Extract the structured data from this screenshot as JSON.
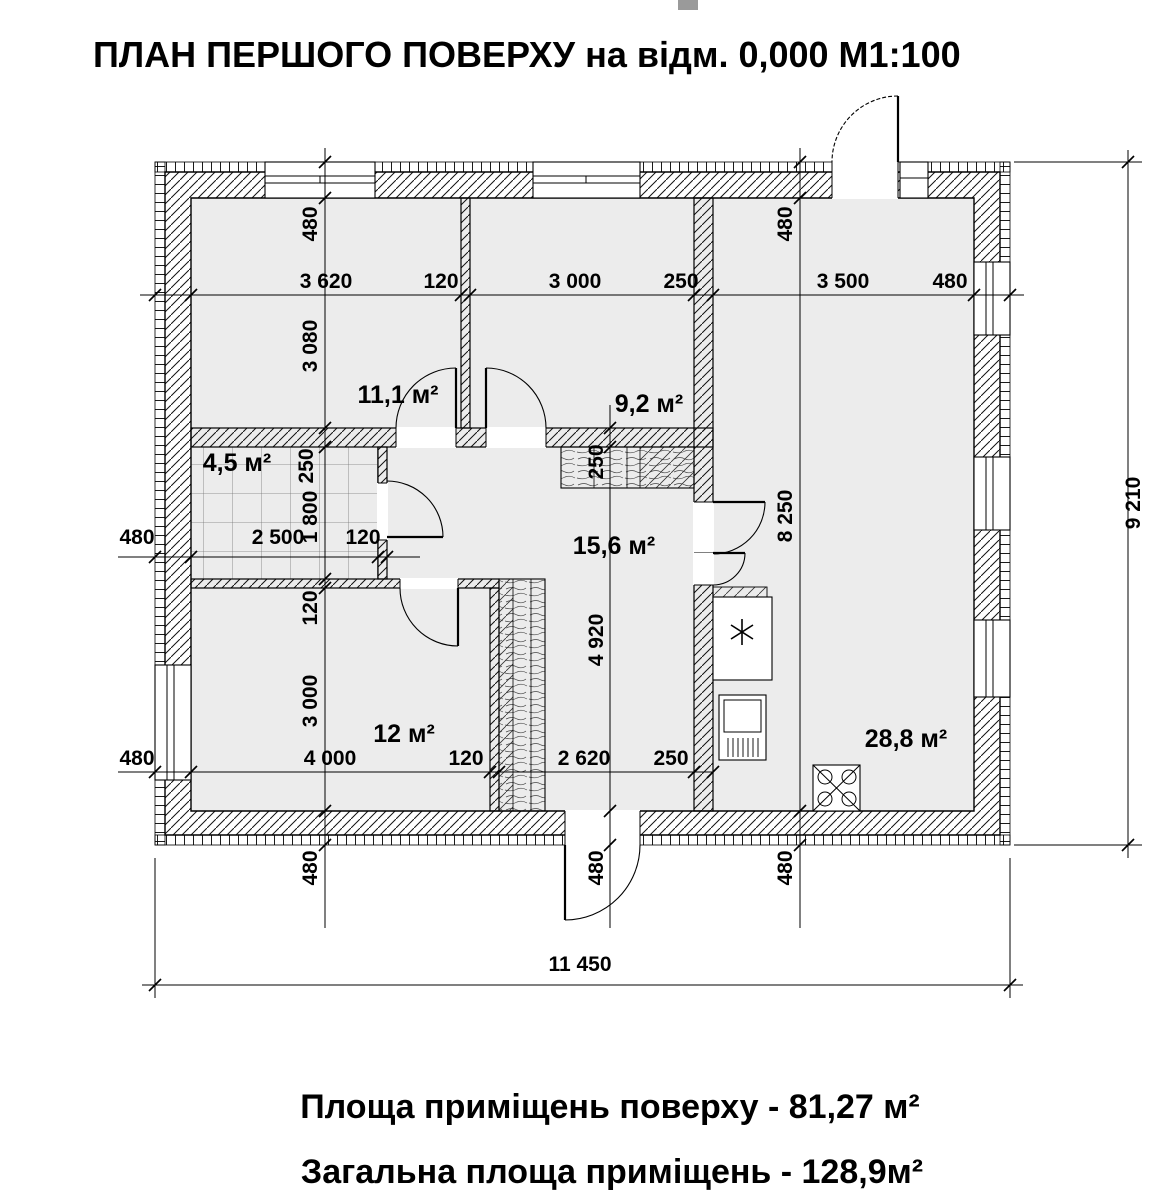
{
  "title": "ПЛАН ПЕРШОГО ПОВЕРХУ на відм. 0,000 М1:100",
  "footer": {
    "line1": "Площа приміщень поверху - 81,27 м²",
    "line2": "Загальна площа приміщень - 128,9м²"
  },
  "rooms": {
    "bedroom_top_left": "11,1 м²",
    "bedroom_top_mid": "9,2 м²",
    "bathroom": "4,5 м²",
    "hall": "15,6 м²",
    "bedroom_bottom": "12 м²",
    "living_kitchen": "28,8 м²"
  },
  "dimensions": {
    "top_row": [
      "3 620",
      "120",
      "3 000",
      "250",
      "3 500",
      "480"
    ],
    "mid_row": [
      "480",
      "2 500",
      "120"
    ],
    "bottom_row": [
      "480",
      "4 000",
      "120",
      "2 620",
      "250"
    ],
    "left_column": [
      "480",
      "3 080",
      "250",
      "1 800",
      "120",
      "3 000"
    ],
    "center_column": [
      "250",
      "4 920"
    ],
    "right_column": [
      "480",
      "8 250"
    ],
    "under_wall": [
      "480",
      "480",
      "480"
    ],
    "overall_width": "11 450",
    "overall_height": "9 210"
  }
}
